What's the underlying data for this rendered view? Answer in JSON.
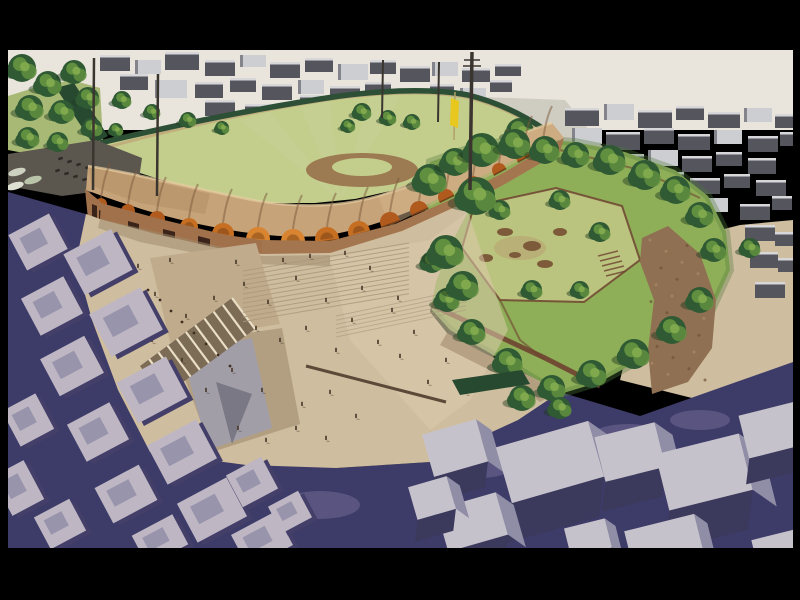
{
  "image": {
    "alt": "Aerial architectural rendering of a baseball stadium with a scalloped brick vault canopy, a large paved public plaza with staircases and people, a tree-filled park, a baseball field with floodlight masts and a yellow flag, surrounded by grey city blocks and indigo streets, letterboxed in black",
    "width": 800,
    "height": 600
  },
  "palette": {
    "black": "#000000",
    "sky": "#e9e5dc",
    "pavement": "#cfccc2",
    "field": "#c3cd8c",
    "field_dark": "#a7b975",
    "fence": "#2c4f35",
    "hedge_dark": "#27492f",
    "warning": "#bfa679",
    "dirt": "#9c7a52",
    "lot_grey": "#5b564e",
    "tree_dark": "#2f5a33",
    "tree_mid": "#5f8f3f",
    "tree_light": "#7fa94c",
    "tree_shadow": "#1e3a20",
    "bldg_dark": "#54555d",
    "bldg_light": "#cdced2",
    "roof_edge_light": "#e6e6e8",
    "roof_tan": "#c7a379",
    "roof_tan_light": "#d6b58c",
    "roof_tan_dark": "#ab8660",
    "roof_groove": "#7c5a3c",
    "roof_highlight": "#e7ceA2",
    "arch_orange": "#b05a1e",
    "arch_copper": "#c66f22",
    "arch_bright": "#d98430",
    "brick": "#a1714c",
    "apron": "#a3764f",
    "opening_dark": "#3a241a",
    "plaza": "#cfbd9f",
    "plaza_light": "#ddcbad",
    "plaza_shade": "#a08a6c",
    "tri_a": "#c0ac8c",
    "tri_b": "#b29f81",
    "ramp_grey": "#a19eaa",
    "ramp_dark": "#7b7886",
    "stair_base": "#7c6c56",
    "stair_stripe": "#eadfc6",
    "step_line": "#ab997c",
    "bench": "#5c4a38",
    "person": "#463626",
    "bird": "#3f2f22",
    "street_navy": "#3d3b68",
    "street_lavender": "#9b93b8",
    "block_top": "#beb7c3",
    "block_roof": "#8f8ba6",
    "block_shadow": "#433f69",
    "cube_top": "#c6c2cb",
    "cube_front": "#3b395c",
    "cube_side": "#908da6",
    "park_base": "#8fae58",
    "park_clearing": "#bac47e",
    "park_fringe": "#4f7a3d",
    "path_brown": "#8f7052",
    "wall_brown": "#6e4330",
    "sculpt": "#7d5b3a",
    "flag_yellow": "#e8c71f",
    "flag_pole": "#b0a068",
    "pole": "#3b352f",
    "car_light": "#ccd2bf",
    "dot_dark": "#2e2a26"
  },
  "scene": {
    "letterbox": {
      "top": 50,
      "bottom": 52,
      "left": 8,
      "right": 7
    },
    "left_trees": [
      [
        22,
        68,
        14
      ],
      [
        48,
        84,
        13
      ],
      [
        74,
        72,
        12
      ],
      [
        30,
        108,
        13
      ],
      [
        62,
        112,
        12
      ],
      [
        88,
        98,
        11
      ],
      [
        28,
        138,
        11
      ],
      [
        58,
        142,
        10
      ],
      [
        92,
        128,
        10
      ],
      [
        122,
        100,
        9
      ],
      [
        152,
        112,
        8
      ],
      [
        188,
        120,
        8
      ],
      [
        222,
        128,
        7
      ],
      [
        116,
        130,
        7
      ]
    ],
    "fence_trees": [
      [
        362,
        112,
        9
      ],
      [
        388,
        118,
        8
      ],
      [
        412,
        122,
        8
      ],
      [
        348,
        126,
        7
      ],
      [
        520,
        132,
        14
      ],
      [
        548,
        148,
        13
      ]
    ],
    "park_trees": [
      [
        430,
        180,
        16
      ],
      [
        455,
        162,
        14
      ],
      [
        482,
        150,
        17
      ],
      [
        515,
        144,
        15
      ],
      [
        545,
        150,
        14
      ],
      [
        576,
        155,
        13
      ],
      [
        610,
        160,
        15
      ],
      [
        645,
        175,
        15
      ],
      [
        676,
        190,
        14
      ],
      [
        700,
        215,
        13
      ],
      [
        714,
        250,
        12
      ],
      [
        700,
        300,
        13
      ],
      [
        672,
        330,
        14
      ],
      [
        634,
        354,
        15
      ],
      [
        592,
        374,
        14
      ],
      [
        552,
        388,
        13
      ],
      [
        508,
        362,
        14
      ],
      [
        472,
        332,
        13
      ],
      [
        447,
        300,
        12
      ],
      [
        432,
        262,
        11
      ],
      [
        500,
        210,
        10
      ],
      [
        560,
        200,
        10
      ],
      [
        600,
        232,
        10
      ],
      [
        532,
        290,
        10
      ],
      [
        580,
        290,
        9
      ],
      [
        476,
        196,
        19
      ],
      [
        446,
        252,
        17
      ],
      [
        463,
        286,
        15
      ],
      [
        522,
        398,
        13
      ],
      [
        560,
        408,
        11
      ],
      [
        750,
        248,
        10
      ]
    ],
    "poles": [
      [
        93,
        190,
        94,
        58,
        2.5
      ],
      [
        157,
        196,
        158,
        74,
        2.5
      ],
      [
        382,
        118,
        383,
        60,
        2
      ],
      [
        438,
        122,
        439,
        62,
        2
      ],
      [
        470,
        190,
        472,
        52,
        3.5
      ]
    ],
    "arches": [
      [
        101,
        204,
        6,
        0
      ],
      [
        128,
        211,
        7,
        0
      ],
      [
        157,
        219,
        8,
        0
      ],
      [
        189,
        227,
        9,
        1
      ],
      [
        223,
        234,
        11,
        1
      ],
      [
        258,
        239,
        12,
        2
      ],
      [
        293,
        241,
        12,
        2
      ],
      [
        327,
        239,
        12,
        1
      ],
      [
        359,
        232,
        11,
        1
      ],
      [
        390,
        222,
        10,
        0
      ],
      [
        419,
        210,
        9,
        0
      ],
      [
        446,
        197,
        8,
        0
      ],
      [
        473,
        184,
        8,
        0
      ],
      [
        499,
        170,
        7,
        0
      ],
      [
        523,
        157,
        7,
        0
      ],
      [
        543,
        146,
        6,
        0
      ]
    ],
    "people": [
      [
        138,
        268
      ],
      [
        155,
        296
      ],
      [
        170,
        262
      ],
      [
        186,
        318
      ],
      [
        214,
        300
      ],
      [
        236,
        264
      ],
      [
        244,
        286
      ],
      [
        256,
        330
      ],
      [
        268,
        304
      ],
      [
        280,
        342
      ],
      [
        296,
        280
      ],
      [
        306,
        330
      ],
      [
        326,
        302
      ],
      [
        336,
        352
      ],
      [
        352,
        322
      ],
      [
        362,
        290
      ],
      [
        378,
        344
      ],
      [
        392,
        312
      ],
      [
        400,
        358
      ],
      [
        414,
        334
      ],
      [
        330,
        394
      ],
      [
        302,
        406
      ],
      [
        262,
        392
      ],
      [
        232,
        372
      ],
      [
        206,
        392
      ],
      [
        182,
        362
      ],
      [
        152,
        342
      ],
      [
        428,
        384
      ],
      [
        446,
        362
      ],
      [
        466,
        394
      ],
      [
        238,
        430
      ],
      [
        266,
        442
      ],
      [
        296,
        430
      ],
      [
        326,
        440
      ],
      [
        356,
        418
      ],
      [
        398,
        300
      ],
      [
        370,
        270
      ],
      [
        345,
        255
      ],
      [
        310,
        258
      ],
      [
        283,
        262
      ]
    ],
    "birds": [
      [
        160,
        300
      ],
      [
        171,
        311
      ],
      [
        182,
        322
      ],
      [
        194,
        333
      ],
      [
        206,
        344
      ],
      [
        218,
        355
      ],
      [
        230,
        366
      ],
      [
        148,
        290
      ]
    ],
    "city_top_left": [
      [
        100,
        55,
        30,
        16,
        0
      ],
      [
        135,
        60,
        26,
        14,
        1
      ],
      [
        165,
        52,
        34,
        18,
        0
      ],
      [
        205,
        60,
        30,
        16,
        0
      ],
      [
        240,
        55,
        26,
        12,
        1
      ],
      [
        270,
        62,
        30,
        16,
        0
      ],
      [
        305,
        58,
        28,
        14,
        0
      ],
      [
        338,
        64,
        30,
        16,
        1
      ],
      [
        370,
        60,
        26,
        14,
        0
      ],
      [
        400,
        66,
        30,
        16,
        0
      ],
      [
        432,
        62,
        26,
        14,
        1
      ],
      [
        462,
        68,
        28,
        14,
        0
      ],
      [
        495,
        64,
        26,
        12,
        0
      ],
      [
        120,
        74,
        28,
        16,
        0
      ],
      [
        155,
        80,
        32,
        18,
        1
      ],
      [
        195,
        82,
        28,
        16,
        0
      ],
      [
        230,
        78,
        26,
        14,
        0
      ],
      [
        262,
        84,
        30,
        16,
        0
      ],
      [
        298,
        80,
        26,
        14,
        1
      ],
      [
        330,
        86,
        30,
        16,
        0
      ],
      [
        365,
        82,
        26,
        14,
        0
      ],
      [
        398,
        88,
        28,
        14,
        0
      ],
      [
        430,
        84,
        24,
        12,
        0
      ],
      [
        460,
        88,
        26,
        14,
        1
      ],
      [
        205,
        100,
        30,
        16,
        0
      ],
      [
        245,
        104,
        26,
        14,
        0
      ],
      [
        280,
        108,
        30,
        16,
        0
      ],
      [
        318,
        104,
        26,
        14,
        1
      ],
      [
        352,
        108,
        28,
        14,
        0
      ],
      [
        386,
        104,
        24,
        12,
        0
      ],
      [
        300,
        95,
        22,
        12,
        0
      ],
      [
        490,
        80,
        22,
        12,
        0
      ]
    ],
    "city_top_right": [
      [
        565,
        108,
        34,
        18,
        0
      ],
      [
        604,
        104,
        30,
        16,
        1
      ],
      [
        638,
        110,
        34,
        18,
        0
      ],
      [
        676,
        106,
        28,
        14,
        0
      ],
      [
        708,
        112,
        32,
        16,
        0
      ],
      [
        744,
        108,
        28,
        14,
        1
      ],
      [
        775,
        114,
        18,
        14,
        0
      ],
      [
        572,
        128,
        30,
        16,
        1
      ],
      [
        606,
        132,
        34,
        18,
        0
      ],
      [
        644,
        128,
        30,
        16,
        0
      ],
      [
        678,
        134,
        32,
        16,
        0
      ],
      [
        714,
        130,
        28,
        14,
        1
      ],
      [
        748,
        136,
        30,
        16,
        0
      ],
      [
        780,
        132,
        13,
        14,
        0
      ],
      [
        580,
        150,
        32,
        16,
        0
      ],
      [
        616,
        154,
        28,
        14,
        0
      ],
      [
        648,
        150,
        30,
        16,
        1
      ],
      [
        682,
        156,
        30,
        16,
        0
      ],
      [
        716,
        152,
        26,
        14,
        0
      ],
      [
        748,
        158,
        28,
        16,
        0
      ],
      [
        585,
        172,
        30,
        16,
        1
      ],
      [
        620,
        176,
        32,
        16,
        0
      ],
      [
        656,
        172,
        28,
        14,
        0
      ],
      [
        690,
        178,
        30,
        16,
        0
      ],
      [
        724,
        174,
        26,
        14,
        0
      ],
      [
        756,
        180,
        30,
        16,
        0
      ],
      [
        600,
        196,
        28,
        14,
        0
      ],
      [
        640,
        200,
        30,
        16,
        0
      ],
      [
        700,
        198,
        28,
        14,
        1
      ],
      [
        740,
        204,
        30,
        16,
        0
      ],
      [
        772,
        196,
        20,
        14,
        0
      ],
      [
        745,
        225,
        30,
        16,
        0
      ],
      [
        775,
        232,
        18,
        14,
        0
      ],
      [
        750,
        252,
        28,
        16,
        0
      ],
      [
        778,
        258,
        15,
        14,
        0
      ],
      [
        755,
        282,
        30,
        16,
        0
      ]
    ],
    "blocks_bottom_left": [
      [
        38,
        242,
        46,
        40
      ],
      [
        98,
        262,
        54,
        46
      ],
      [
        52,
        306,
        48,
        42
      ],
      [
        126,
        322,
        58,
        48
      ],
      [
        72,
        366,
        50,
        42
      ],
      [
        152,
        390,
        56,
        46
      ],
      [
        98,
        432,
        48,
        42
      ],
      [
        182,
        452,
        56,
        44
      ],
      [
        126,
        494,
        50,
        40
      ],
      [
        212,
        510,
        56,
        44
      ],
      [
        160,
        540,
        46,
        34
      ],
      [
        262,
        540,
        50,
        38
      ],
      [
        252,
        482,
        40,
        36
      ],
      [
        28,
        420,
        38,
        40
      ],
      [
        18,
        488,
        36,
        44
      ],
      [
        60,
        524,
        40,
        36
      ],
      [
        290,
        512,
        34,
        30
      ]
    ],
    "cubes_bottom_right": [
      [
        455,
        448,
        56,
        44,
        26,
        -16
      ],
      [
        550,
        462,
        96,
        58,
        40,
        -16
      ],
      [
        472,
        522,
        62,
        44,
        30,
        -16
      ],
      [
        630,
        452,
        62,
        46,
        30,
        -14
      ],
      [
        704,
        472,
        86,
        58,
        40,
        -14
      ],
      [
        772,
        430,
        58,
        44,
        26,
        -14
      ],
      [
        664,
        542,
        72,
        40,
        22,
        -14
      ],
      [
        588,
        538,
        42,
        30,
        18,
        -14
      ],
      [
        432,
        498,
        40,
        34,
        22,
        -16
      ],
      [
        778,
        548,
        48,
        28,
        16,
        -14
      ]
    ],
    "sculptures": [
      [
        505,
        232,
        8,
        4
      ],
      [
        532,
        246,
        9,
        5
      ],
      [
        560,
        232,
        7,
        4
      ],
      [
        486,
        258,
        7,
        4
      ],
      [
        545,
        264,
        8,
        4
      ],
      [
        515,
        255,
        6,
        3
      ]
    ],
    "park_steps": [
      [
        598,
        256,
        618,
        251
      ],
      [
        600,
        261,
        620,
        256
      ],
      [
        602,
        266,
        622,
        261
      ],
      [
        604,
        271,
        624,
        266
      ],
      [
        606,
        276,
        626,
        271
      ]
    ],
    "lavender_patches": [
      [
        320,
        505,
        40,
        14
      ],
      [
        480,
        468,
        30,
        10
      ],
      [
        628,
        436,
        36,
        12
      ],
      [
        700,
        420,
        30,
        10
      ],
      [
        200,
        300,
        20,
        8
      ],
      [
        140,
        250,
        16,
        6
      ]
    ],
    "parking_dots": [
      [
        58,
        158
      ],
      [
        67,
        161
      ],
      [
        76,
        164
      ],
      [
        85,
        167
      ],
      [
        94,
        170
      ],
      [
        103,
        173
      ],
      [
        55,
        170
      ],
      [
        64,
        173
      ],
      [
        73,
        176
      ],
      [
        82,
        179
      ],
      [
        91,
        182
      ]
    ],
    "cars": [
      [
        17,
        172
      ],
      [
        33,
        180
      ],
      [
        15,
        186
      ]
    ],
    "stair_stripes": 10,
    "step_lines": 12,
    "ramp_posts": 5,
    "path_speckles": 26
  }
}
